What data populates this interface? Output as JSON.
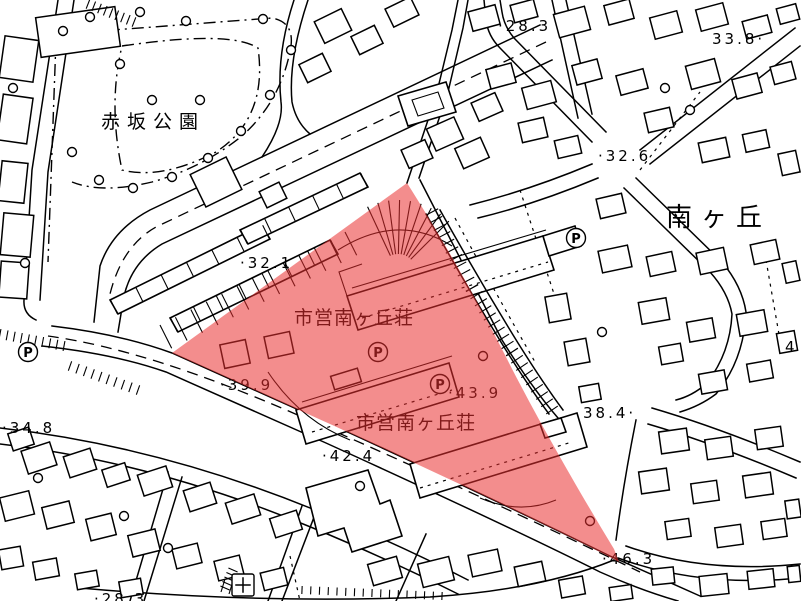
{
  "map": {
    "title": "city-planning-cadastral-map",
    "colors": {
      "background": "#ffffff",
      "line": "#000000",
      "highlight": "#e93030",
      "highlight_opacity": 0.55
    },
    "region_labels": {
      "park": "赤坂公園",
      "district": "南ヶ丘",
      "housing_upper": "市営南ヶ丘荘",
      "housing_lower": "市営南ヶ丘荘"
    },
    "spot_elevations": [
      {
        "label": "·28.3"
      },
      {
        "label": "33.8·"
      },
      {
        "label": "·32.6"
      },
      {
        "label": "·32.1"
      },
      {
        "label": "·39.9"
      },
      {
        "label": "·43.9"
      },
      {
        "label": "38.4·"
      },
      {
        "label": "·34.8"
      },
      {
        "label": "·42.4"
      },
      {
        "label": "·46.3"
      },
      {
        "label": "·28.3"
      },
      {
        "label": "4"
      }
    ],
    "parking_label": "P"
  }
}
